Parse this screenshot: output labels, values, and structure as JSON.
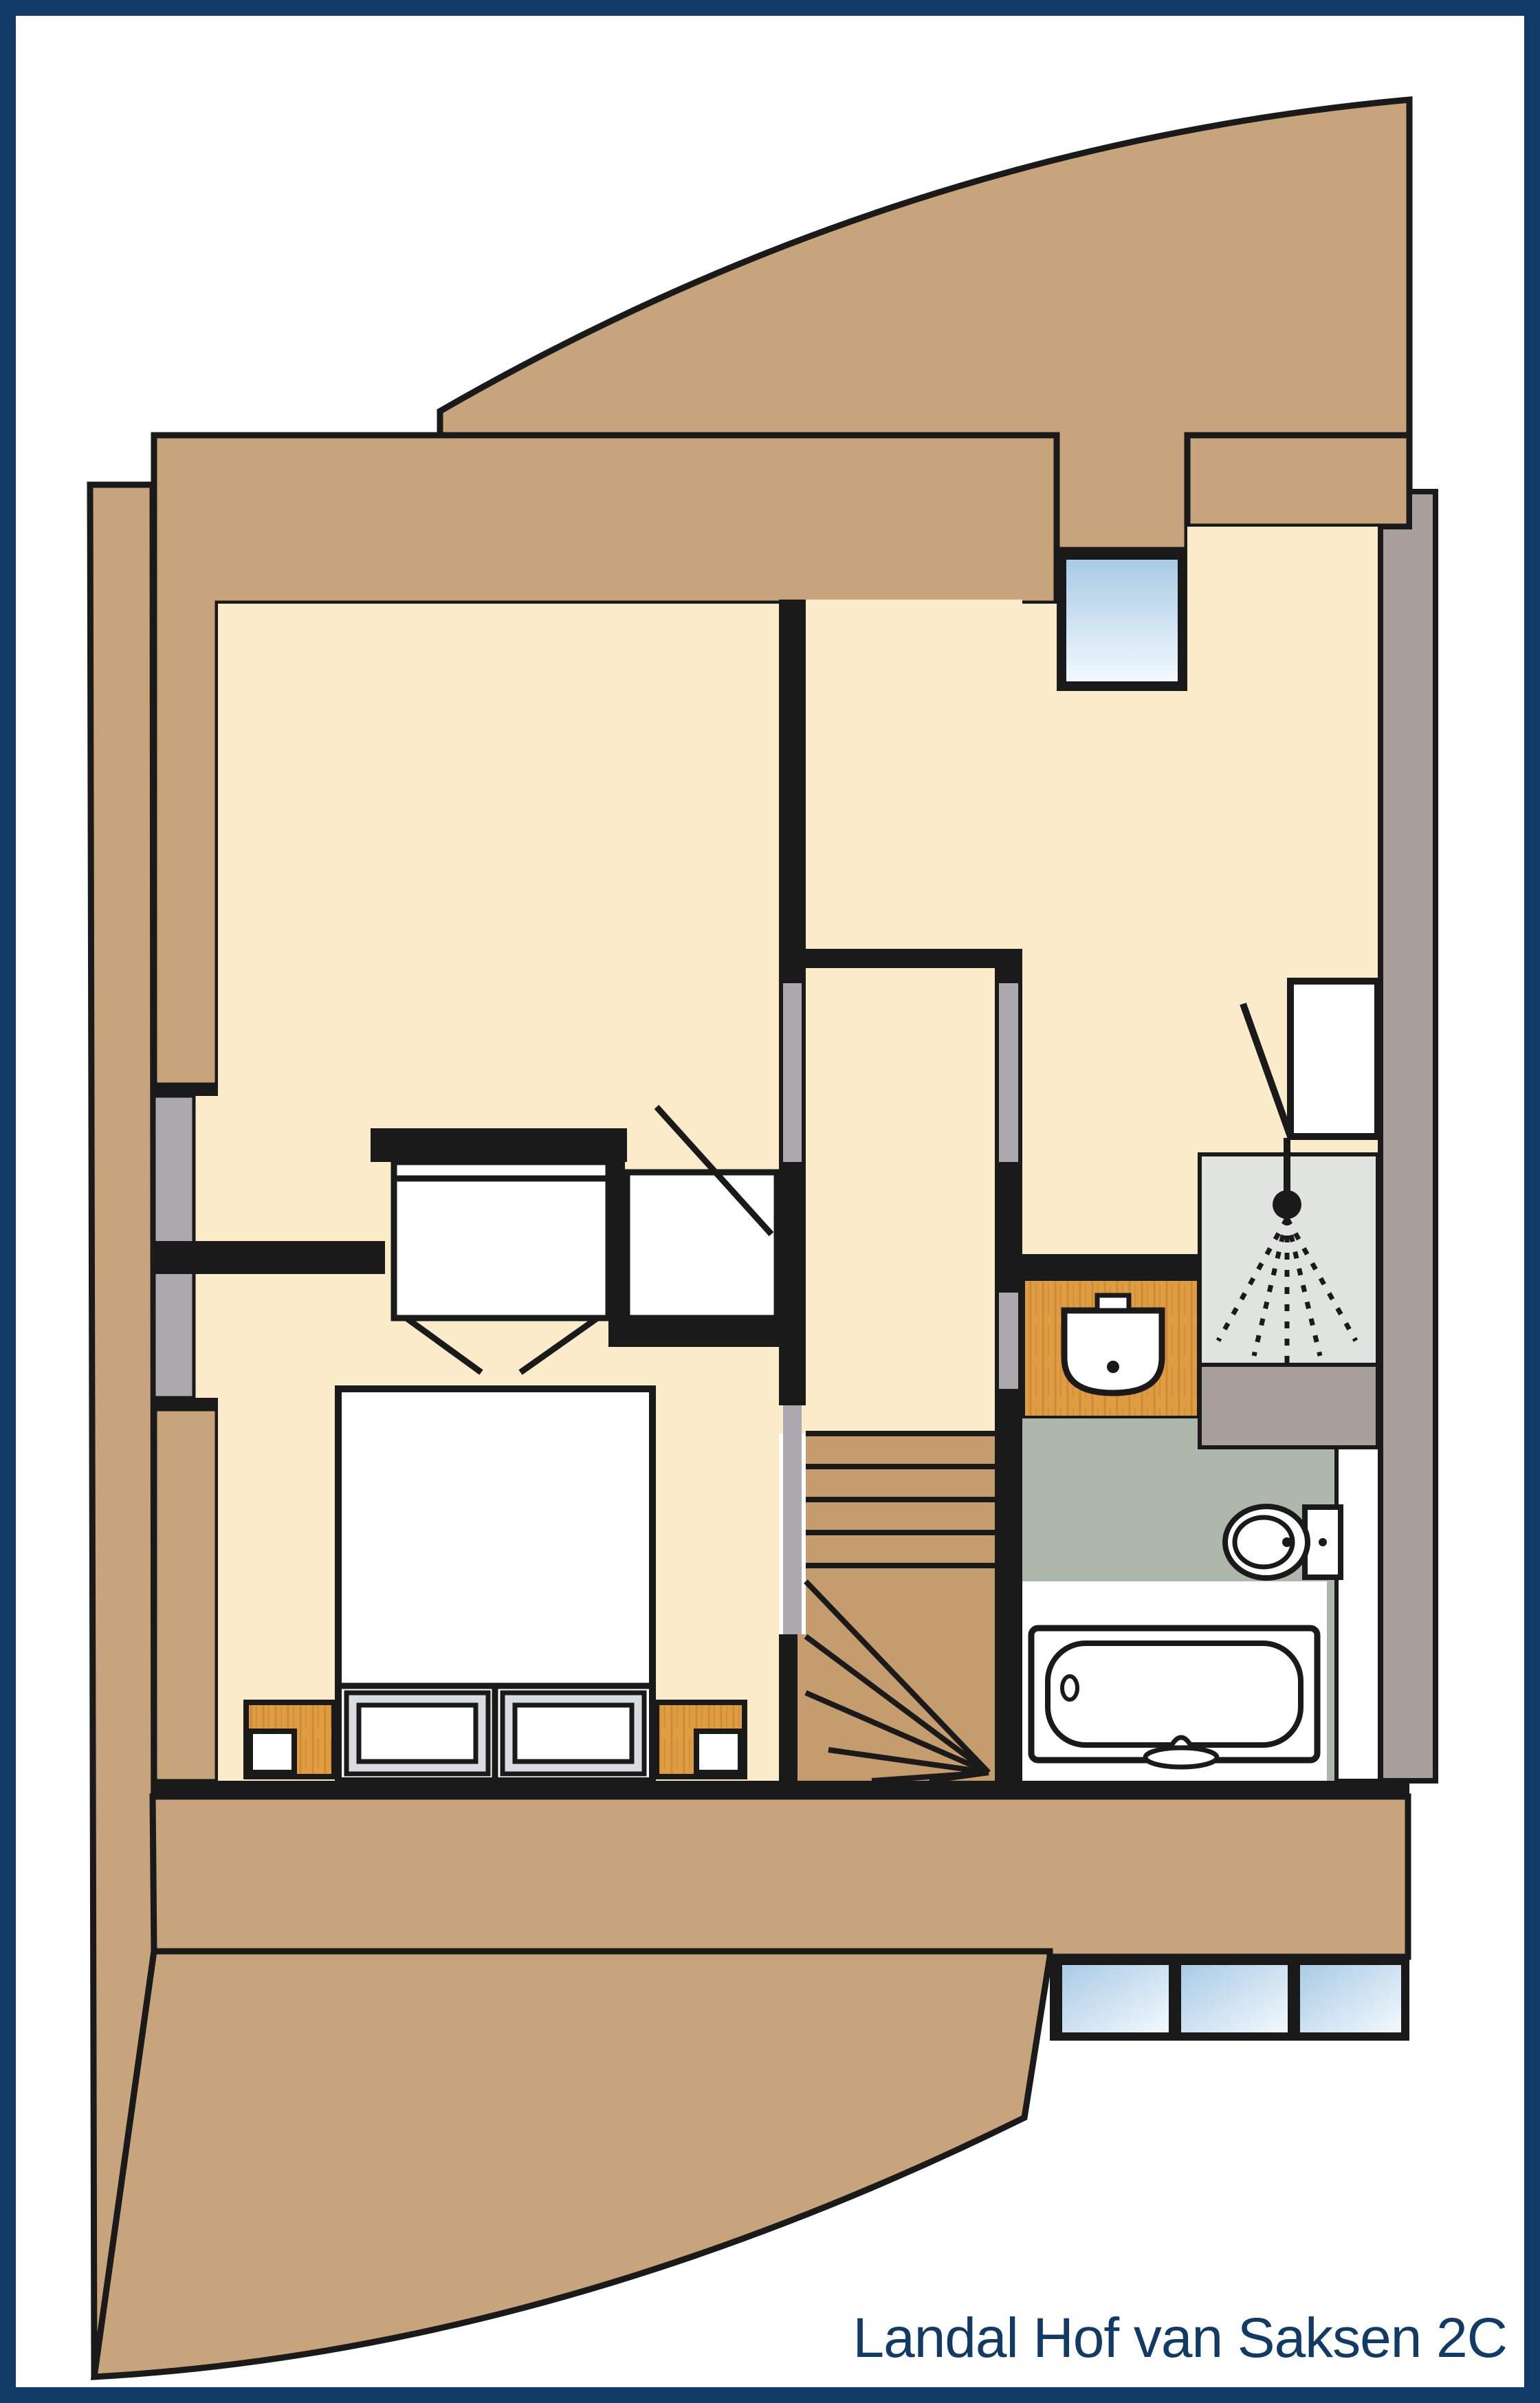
{
  "title": {
    "text": "Landal Hof van Saksen 2C"
  },
  "palette": {
    "navy": "#123A66",
    "white": "#FFFFFF",
    "line": "#1A1A1A",
    "roof_tan": "#C7A47B",
    "stair_tan": "#C59C6D",
    "cream": "#FAECC8",
    "wood": "#DF9C41",
    "wood_grain": "#B97F2B",
    "bath_floor": "#AFB6AB",
    "shower_tray": "#DFE4DE",
    "taupe_wall": "#A89E9B",
    "opening_gray": "#ABA9AD",
    "pillow_frame": "#D9DCE1",
    "glass_top": "#A9CBE5",
    "glass_bottom": "#F2F9FD"
  },
  "floorplan": {
    "floor_label": "",
    "rooms": [
      {
        "id": "bedroom-main",
        "side": "bottom-left"
      },
      {
        "id": "bedroom-second",
        "side": "top-left"
      },
      {
        "id": "landing",
        "side": "center"
      },
      {
        "id": "bathroom",
        "side": "right"
      }
    ],
    "fixtures": [
      "double-bed",
      "pillow-left",
      "pillow-right",
      "nightstand-left",
      "nightstand-right",
      "lamp-left",
      "lamp-right",
      "wardrobe-bifold",
      "interior-door",
      "winder-staircase",
      "washbasin",
      "shower-cabin",
      "shower-head",
      "toilet",
      "bathtub",
      "dormer-window-top",
      "knee-wall-window-left",
      "window-row-bottom"
    ],
    "window_pane_counts": {
      "top": 1,
      "left": 1,
      "bottom_row": 3
    }
  }
}
